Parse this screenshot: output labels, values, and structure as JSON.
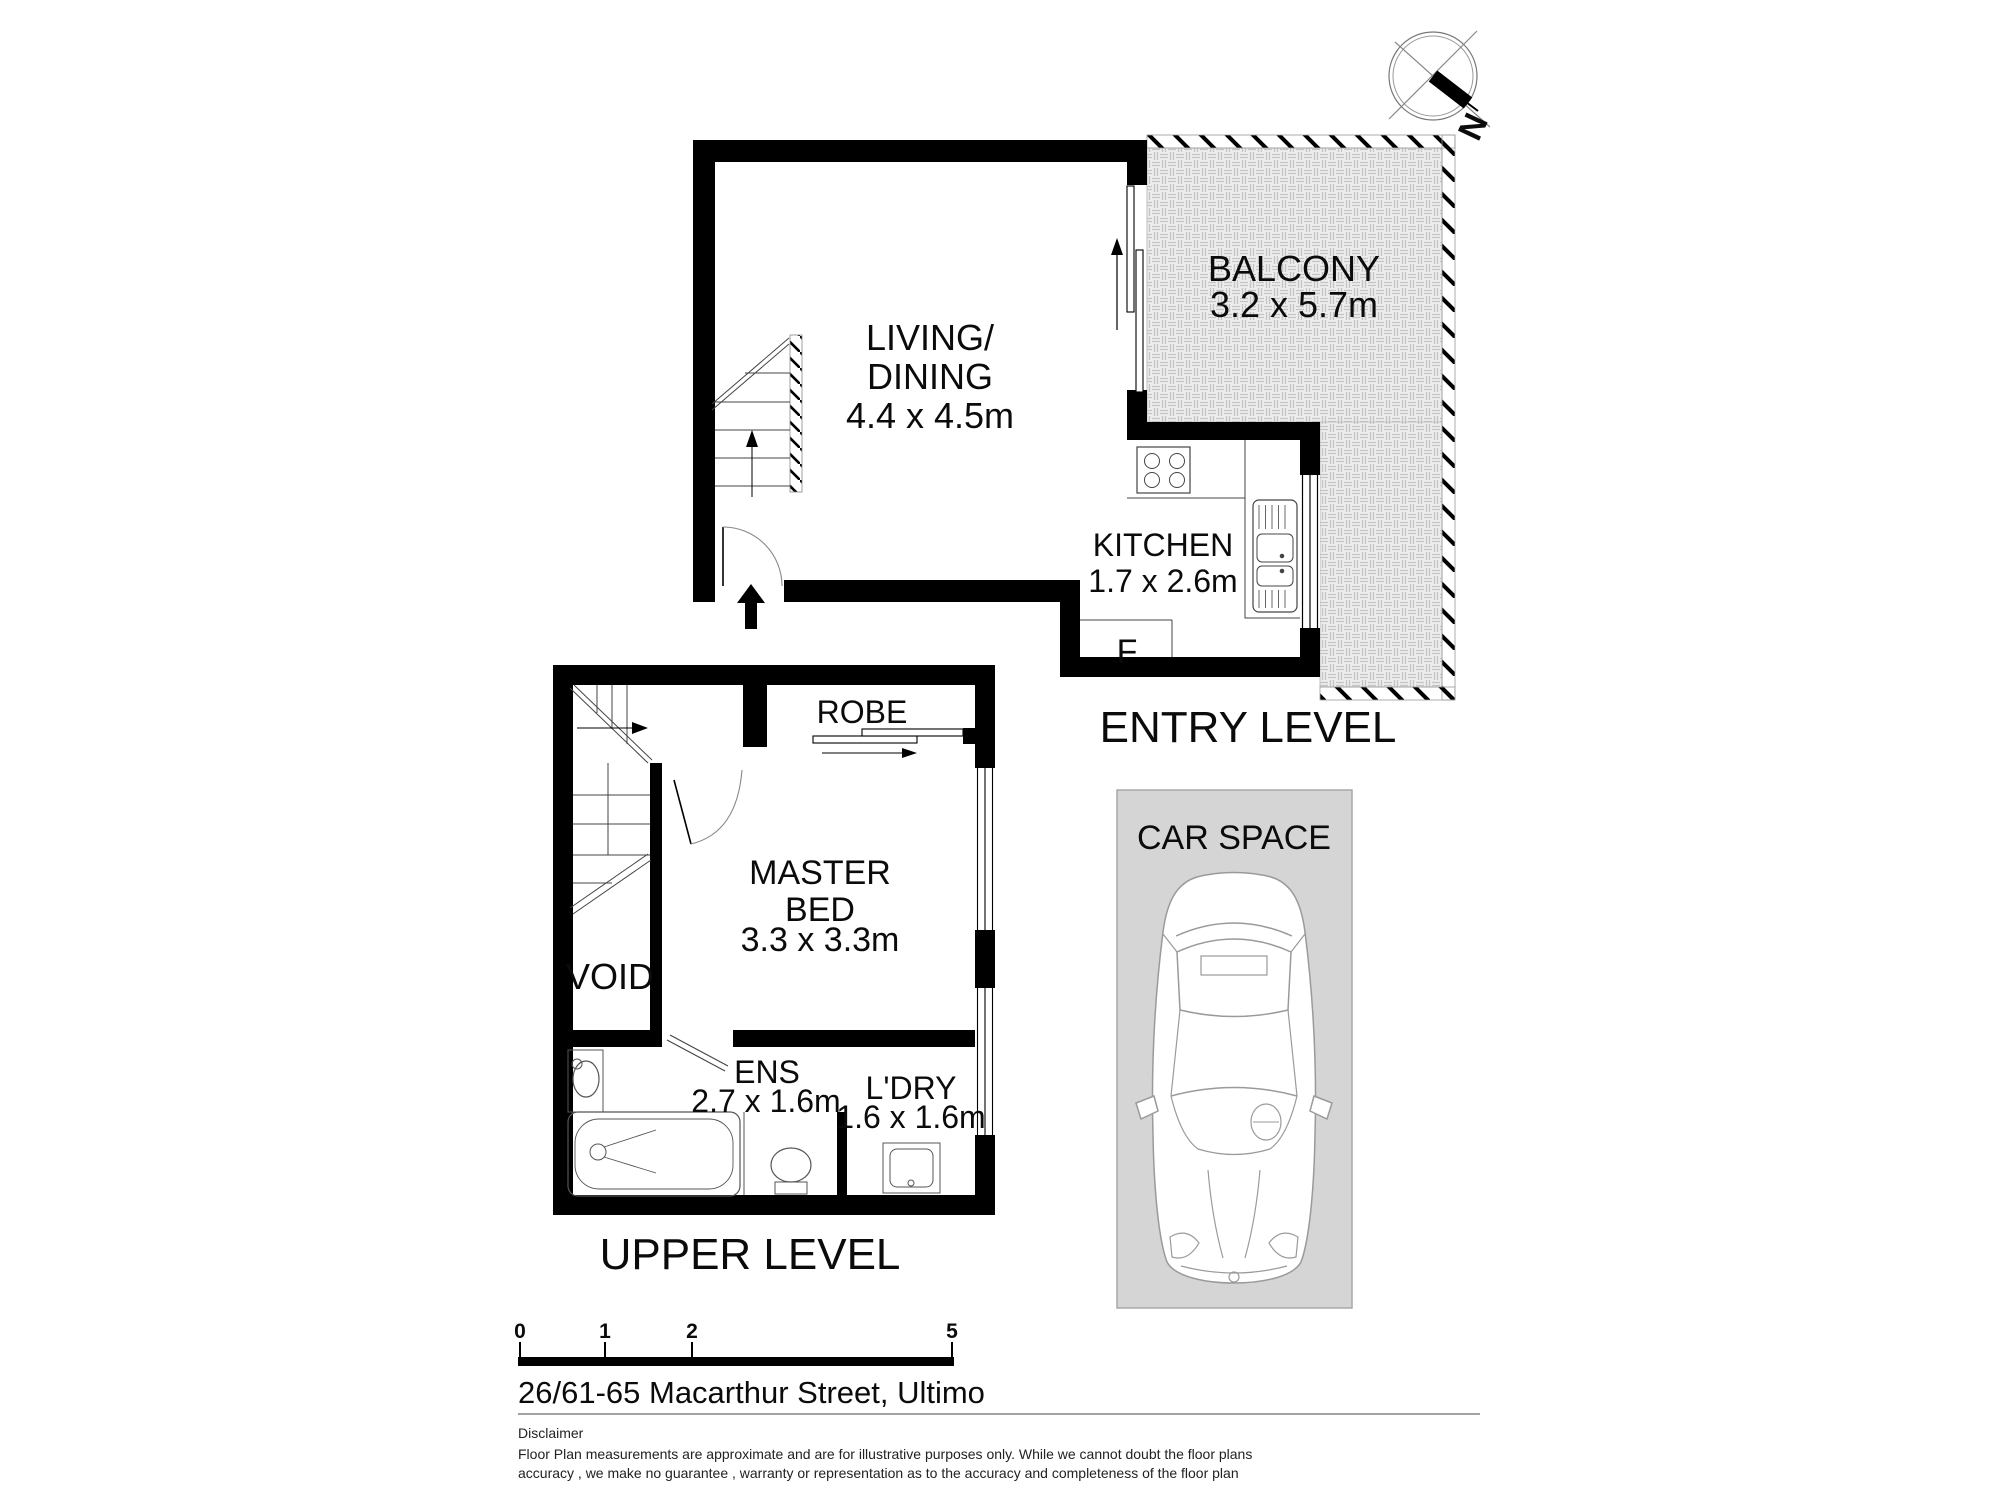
{
  "compass": {
    "north_label": "N"
  },
  "entry_level": {
    "title": "ENTRY LEVEL",
    "living": {
      "label_line1": "LIVING/",
      "label_line2": "DINING",
      "dims": "4.4 x 4.5m"
    },
    "balcony": {
      "label": "BALCONY",
      "dims": "3.2 x 5.7m"
    },
    "kitchen": {
      "label": "KITCHEN",
      "dims": "1.7 x 2.6m",
      "fridge_label": "F"
    }
  },
  "upper_level": {
    "title": "UPPER LEVEL",
    "robe": {
      "label": "ROBE"
    },
    "master_bed": {
      "label_line1": "MASTER",
      "label_line2": "BED",
      "dims": "3.3 x 3.3m"
    },
    "void": {
      "label": "VOID"
    },
    "ensuite": {
      "label": "ENS",
      "dims": "2.7 x 1.6m"
    },
    "laundry": {
      "label": "L'DRY",
      "dims": "1.6 x 1.6m"
    }
  },
  "car_space": {
    "label": "CAR SPACE"
  },
  "scale_bar": {
    "ticks": [
      "0",
      "1",
      "2",
      "5"
    ]
  },
  "address": "26/61-65 Macarthur Street, Ultimo",
  "disclaimer": {
    "heading": "Disclaimer",
    "line1": "Floor Plan measurements are approximate and are for illustrative purposes only. While we cannot doubt the floor plans",
    "line2": "accuracy , we make no guarantee , warranty or representation as to the accuracy and completeness of the floor plan"
  },
  "colors": {
    "wall": "#000000",
    "balcony_fill": "#ededed",
    "balcony_weave": "#c4c4c4",
    "car_space_fill": "#d5d5d5",
    "fixture_line": "#555555",
    "car_line": "#9a9a9a"
  }
}
